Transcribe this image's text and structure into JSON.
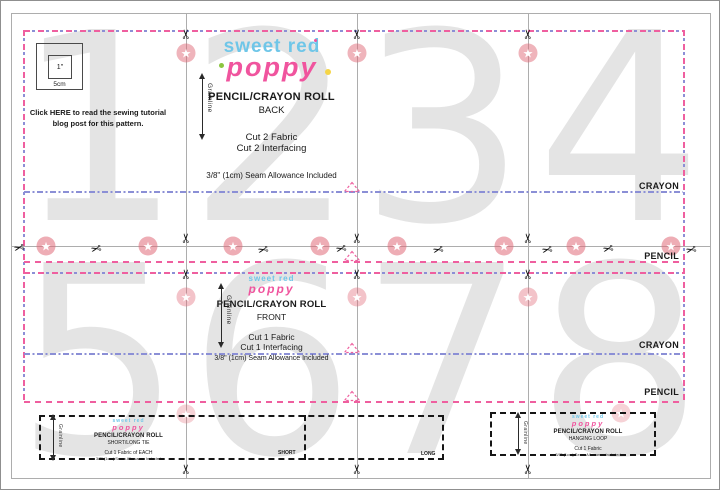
{
  "icons": {
    "scissors": "✂",
    "star": "★"
  },
  "colors": {
    "pattern_pink": "#EF5F9F",
    "fold_blue": "#8B8FD6",
    "logo_blue": "#6FC6E8",
    "logo_pink": "#F0549E",
    "page_number_gray": "#E4E4E4"
  },
  "page_numbers": [
    "1",
    "2",
    "3",
    "4",
    "5",
    "6",
    "7",
    "8"
  ],
  "test_square": {
    "inner_label": "1\"",
    "outer_label": "5cm"
  },
  "tutorial_note": {
    "pre": "Click ",
    "link": "HERE",
    "rest": " to read the sewing tutorial",
    "line2": "blog post for this pattern."
  },
  "logo": {
    "line1": "sweet red",
    "line2": "poppy"
  },
  "back_piece": {
    "title": "PENCIL/CRAYON ROLL",
    "subtitle": "BACK",
    "cut_fabric": "Cut 2 Fabric",
    "cut_interfacing": "Cut 2 Interfacing",
    "seam": "3/8\" (1cm) Seam Allowance Included",
    "grainline": "Grainline",
    "crayon_label": "CRAYON",
    "pencil_label": "PENCIL"
  },
  "front_piece": {
    "title": "PENCIL/CRAYON ROLL",
    "subtitle": "FRONT",
    "cut_fabric": "Cut 1 Fabric",
    "cut_interfacing": "Cut 1 Interfacing",
    "seam": "3/8\" (1cm) Seam Allowance Included",
    "grainline": "Grainline",
    "crayon_label": "CRAYON",
    "pencil_label": "PENCIL"
  },
  "tie_piece": {
    "title": "PENCIL/CRAYON ROLL",
    "subtitle": "SHORT/LONG TIE",
    "cut": "Cut 1 Fabric of EACH",
    "seam": "3/8\" (1cm) Seam Allowance Included",
    "grainline": "Grainline",
    "short_label": "SHORT",
    "long_label": "LONG"
  },
  "loop_piece": {
    "title": "PENCIL/CRAYON ROLL",
    "subtitle": "HANGING LOOP",
    "cut": "Cut 1 Fabric",
    "seam": "3/8\" (1cm) Seam Allowance Included",
    "grainline": "Grainline"
  }
}
